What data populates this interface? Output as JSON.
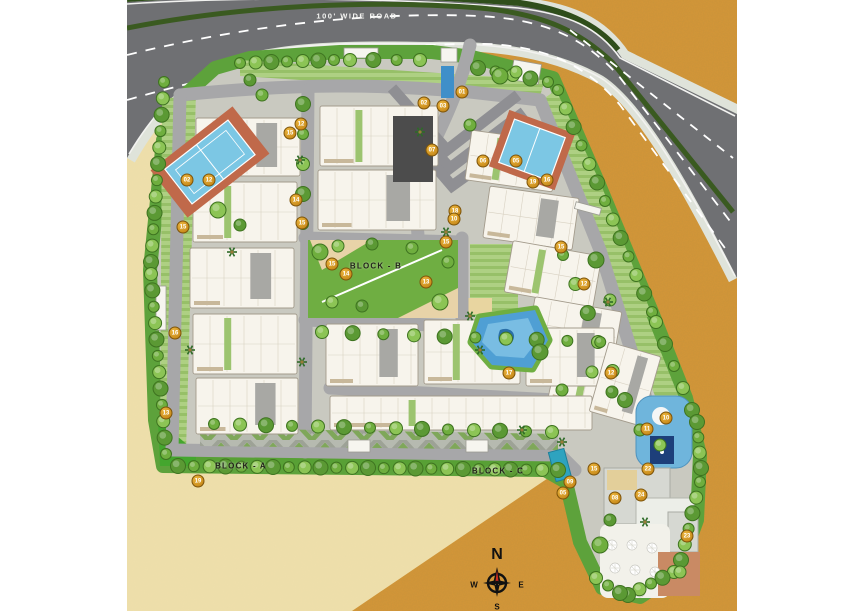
{
  "road": {
    "label": "100' WIDE ROAD"
  },
  "blocks": [
    {
      "label": "BLOCK - A",
      "x": 241,
      "y": 466
    },
    {
      "label": "BLOCK - B",
      "x": 376,
      "y": 266
    },
    {
      "label": "BLOCK - C",
      "x": 498,
      "y": 471
    }
  ],
  "compass": {
    "north": "N",
    "west": "W",
    "east": "E",
    "south": "S"
  },
  "markers": [
    {
      "n": "01",
      "x": 462,
      "y": 92
    },
    {
      "n": "02",
      "x": 424,
      "y": 103
    },
    {
      "n": "03",
      "x": 443,
      "y": 106
    },
    {
      "n": "07",
      "x": 432,
      "y": 150
    },
    {
      "n": "06",
      "x": 483,
      "y": 161
    },
    {
      "n": "05",
      "x": 516,
      "y": 161
    },
    {
      "n": "18",
      "x": 455,
      "y": 211
    },
    {
      "n": "12",
      "x": 301,
      "y": 124
    },
    {
      "n": "15",
      "x": 290,
      "y": 133
    },
    {
      "n": "02",
      "x": 187,
      "y": 180
    },
    {
      "n": "12",
      "x": 209,
      "y": 180
    },
    {
      "n": "15",
      "x": 183,
      "y": 227
    },
    {
      "n": "14",
      "x": 296,
      "y": 200
    },
    {
      "n": "15",
      "x": 302,
      "y": 223
    },
    {
      "n": "16",
      "x": 175,
      "y": 333
    },
    {
      "n": "13",
      "x": 166,
      "y": 413
    },
    {
      "n": "19",
      "x": 198,
      "y": 481
    },
    {
      "n": "15",
      "x": 332,
      "y": 264
    },
    {
      "n": "14",
      "x": 346,
      "y": 274
    },
    {
      "n": "13",
      "x": 426,
      "y": 282
    },
    {
      "n": "15",
      "x": 446,
      "y": 242
    },
    {
      "n": "19",
      "x": 533,
      "y": 182
    },
    {
      "n": "16",
      "x": 547,
      "y": 180
    },
    {
      "n": "15",
      "x": 561,
      "y": 247
    },
    {
      "n": "12",
      "x": 584,
      "y": 284
    },
    {
      "n": "10",
      "x": 454,
      "y": 219
    },
    {
      "n": "17",
      "x": 509,
      "y": 373
    },
    {
      "n": "12",
      "x": 611,
      "y": 373
    },
    {
      "n": "10",
      "x": 666,
      "y": 418
    },
    {
      "n": "11",
      "x": 647,
      "y": 429
    },
    {
      "n": "22",
      "x": 648,
      "y": 469
    },
    {
      "n": "15",
      "x": 594,
      "y": 469
    },
    {
      "n": "09",
      "x": 570,
      "y": 482
    },
    {
      "n": "05",
      "x": 563,
      "y": 493
    },
    {
      "n": "08",
      "x": 615,
      "y": 498
    },
    {
      "n": "24",
      "x": 641,
      "y": 495
    },
    {
      "n": "23",
      "x": 687,
      "y": 536
    }
  ],
  "colors": {
    "gold": "#d59638",
    "sand": "#eedfab",
    "asphalt": "#6f7073",
    "median_green": "#3a5a20",
    "lawn": "#5da23b",
    "pool": "#5aa8d8",
    "court": "#7cc7e4",
    "court_frame": "#c0694a",
    "marker": "#c9891a"
  }
}
